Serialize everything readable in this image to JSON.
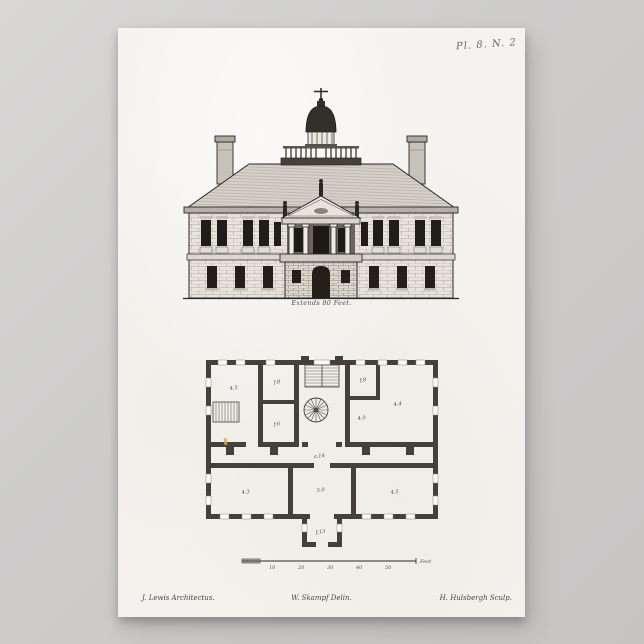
{
  "window": {
    "backdrop_color": "#cccbca"
  },
  "poster": {
    "paper_color": "#f5f3ef",
    "ink_color": "#2b2824",
    "plate_number": "Pl. 8. N. 2",
    "elevation_caption": "Extends 80 Feet.",
    "plan": {
      "labels": {
        "room_tl": "4.5",
        "closet_a": "f.8",
        "closet_b": "f.6",
        "closet_c": "f.8",
        "room_tr": "4.4",
        "note_mr": "4.0",
        "hall": "a.14",
        "room_bl": "4.3",
        "room_bc": "5.0",
        "room_br": "4.5",
        "porch": "f.13"
      },
      "scale_bar": {
        "ticks": [
          "10",
          "20",
          "30",
          "40",
          "50"
        ],
        "unit": "Feet"
      }
    },
    "credits": {
      "architect": "J. Lewis Architectus.",
      "delineator": "W. Skampf Delin.",
      "engraver": "H. Hulsbergh Sculp."
    }
  }
}
